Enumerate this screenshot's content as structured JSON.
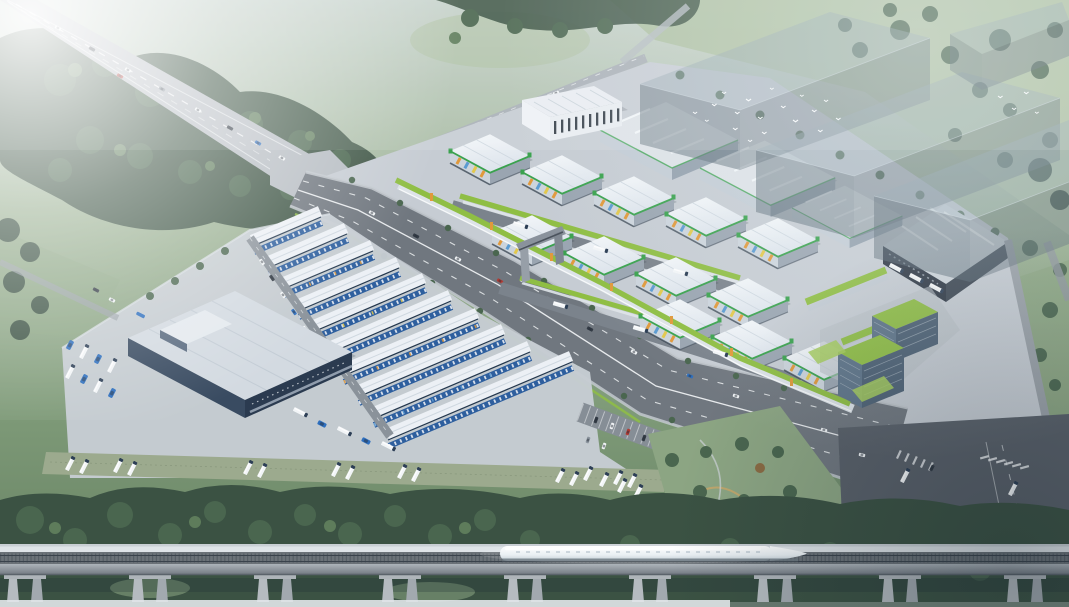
{
  "meta": {
    "subject": "Aerial bird's-eye architectural rendering of a logistics wholesale industrial park",
    "view": "axonometric aerial render, no visible text or UI",
    "width_px": 1069,
    "height_px": 607
  },
  "colors": {
    "bgTop": "#c7d3cc",
    "bgMid": "#9cb294",
    "bgLow": "#7e9a78",
    "bgBottom": "#647f60",
    "fieldLight": "#abbf9e",
    "field": "#8ca583",
    "treeDark": "#3b5243",
    "treeMid": "#4a664f",
    "treeLight": "#5e7c5b",
    "road": "#b6bcc2",
    "roadLight": "#c9ced3",
    "asphalt": "#70777f",
    "asphaltDark": "#596069",
    "lane": "#f4f6f8",
    "plate": "#c6ccd3",
    "apron": "#b8bfc7",
    "roofWhite": "#eef1f5",
    "roofTint": "#e2e8ee",
    "roofShade": "#c7d0d9",
    "ridge": "#cfd8e0",
    "greenTrim": "#3aa24e",
    "greenRoof": "#8fbe44",
    "lawn": "#a5cc5a",
    "facade": "#ccd4dc",
    "facadeSide": "#9aa5b1",
    "orange": "#e0993c",
    "yellow": "#e2c84d",
    "panelBlue": "#5b9bd1",
    "blueFacade": "#2e5f9e",
    "blueDeep": "#22406b",
    "steelWall": "#394b61",
    "steelDark": "#2b3b50",
    "glass": "#5e7489",
    "glassDark": "#4d6175",
    "massing": "#5a6a76",
    "massingTop": "#8fa2ad",
    "deckLight": "#dfe4e8",
    "trackBed": "#6b7278",
    "tie": "#4e565e",
    "girder": "#99a0a7",
    "pier": "#b5bbc0",
    "train": "#f3f7fa",
    "trainShade": "#a9b5bf",
    "carWhite": "#f2f5f7",
    "carDark": "#333b45",
    "carGray": "#8a939c",
    "carRed": "#b23b34",
    "carBlue": "#2e6fbe",
    "shadow": "#1f2c38",
    "pathTan": "#c8a76a"
  },
  "scene": {
    "atmosphere": {
      "haze": "white light haze over top-left corner",
      "mist": "cool mist across horizon"
    },
    "landscape": {
      "tree_masses": "dense dark-green tree clusters framing the site",
      "fields": "pale green meadows top-right"
    },
    "roads": {
      "highway": {
        "orientation": "diagonal from top-left corner to mid-left intersection",
        "cars": 9
      },
      "arterial": {
        "orientation": "diagonal across center toward bottom-right",
        "cars": 12,
        "tree_verges": true
      },
      "perimeter_road_cars": 3,
      "bottom_right_intersection": {
        "crosswalks": 2,
        "vehicles": 4
      }
    },
    "rail": {
      "viaduct": "elevated rail viaduct spanning full width near bottom",
      "piers": 9,
      "train": {
        "type": "high-speed train",
        "color": "white",
        "position": "center-left on viaduct"
      }
    },
    "park": {
      "right_cluster": {
        "white_roof_warehouses": 12,
        "roof_accent": "green eave trim",
        "facade_panels": [
          "orange",
          "yellow",
          "light blue"
        ],
        "gray_warehouses": 3,
        "depot_building": 1,
        "exhibition_hall": {
          "color": "white",
          "windows": "dark vertical strips"
        },
        "entrance_gate": 1,
        "green_roof_street_strips": 3,
        "office_towers": {
          "towers": 2,
          "wings": 2,
          "roofs": "planted green",
          "facade": "blue glass"
        },
        "lane_trucks": 6,
        "depot_trucks": 3
      },
      "left_cluster": {
        "warehouse_rows": 10,
        "roofs": "white",
        "facades": "blue",
        "cold_storage_building": {
          "roof": "light gray",
          "walls": "dark slate blue"
        },
        "spine_vehicles": 6,
        "dock_trucks": 5,
        "blue_truck_yard": 8,
        "truck_parking_strip": {
          "groups": 7,
          "trucks": 14
        }
      },
      "south_parking": {
        "cars": 6,
        "trucks": 4
      },
      "fork_park": "triangular lawn with trees and winding path"
    },
    "future_phase": {
      "translucent_massing_blocks": 4
    },
    "wildlife": {
      "bird_flock": 22,
      "color": "white"
    }
  }
}
